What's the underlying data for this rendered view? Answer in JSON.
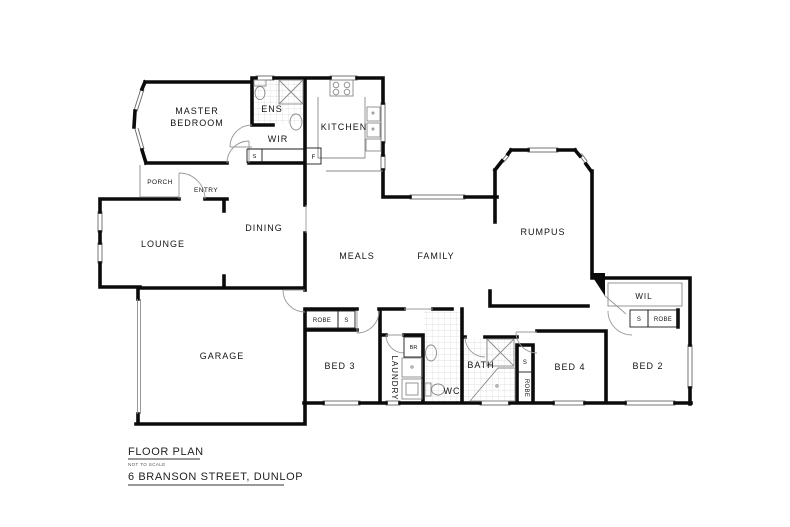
{
  "plan": {
    "rooms": {
      "master_line1": "MASTER",
      "master_line2": "BEDROOM",
      "ens": "ENS",
      "wir": "WIR",
      "kitchen": "KITCHEN",
      "porch": "PORCH",
      "entry": "ENTRY",
      "lounge": "LOUNGE",
      "dining": "DINING",
      "meals": "MEALS",
      "family": "FAMILY",
      "rumpus": "RUMPUS",
      "wil": "WIL",
      "garage": "GARAGE",
      "bed3": "BED 3",
      "laundry": "LAUNDRY",
      "wc": "WC",
      "bath": "BATH",
      "bed4": "BED 4",
      "bed2": "BED 2"
    },
    "storage": {
      "robe": "ROBE",
      "s": "S",
      "fridge": "F",
      "broom": "BR"
    },
    "colors": {
      "wall": "#0b0b0b",
      "fixture": "#8a8a8a",
      "tile": "#d8d8d8"
    }
  },
  "footer": {
    "title": "FLOOR PLAN",
    "subtitle": "NOT TO SCALE",
    "address": "6 BRANSON STREET, DUNLOP"
  }
}
